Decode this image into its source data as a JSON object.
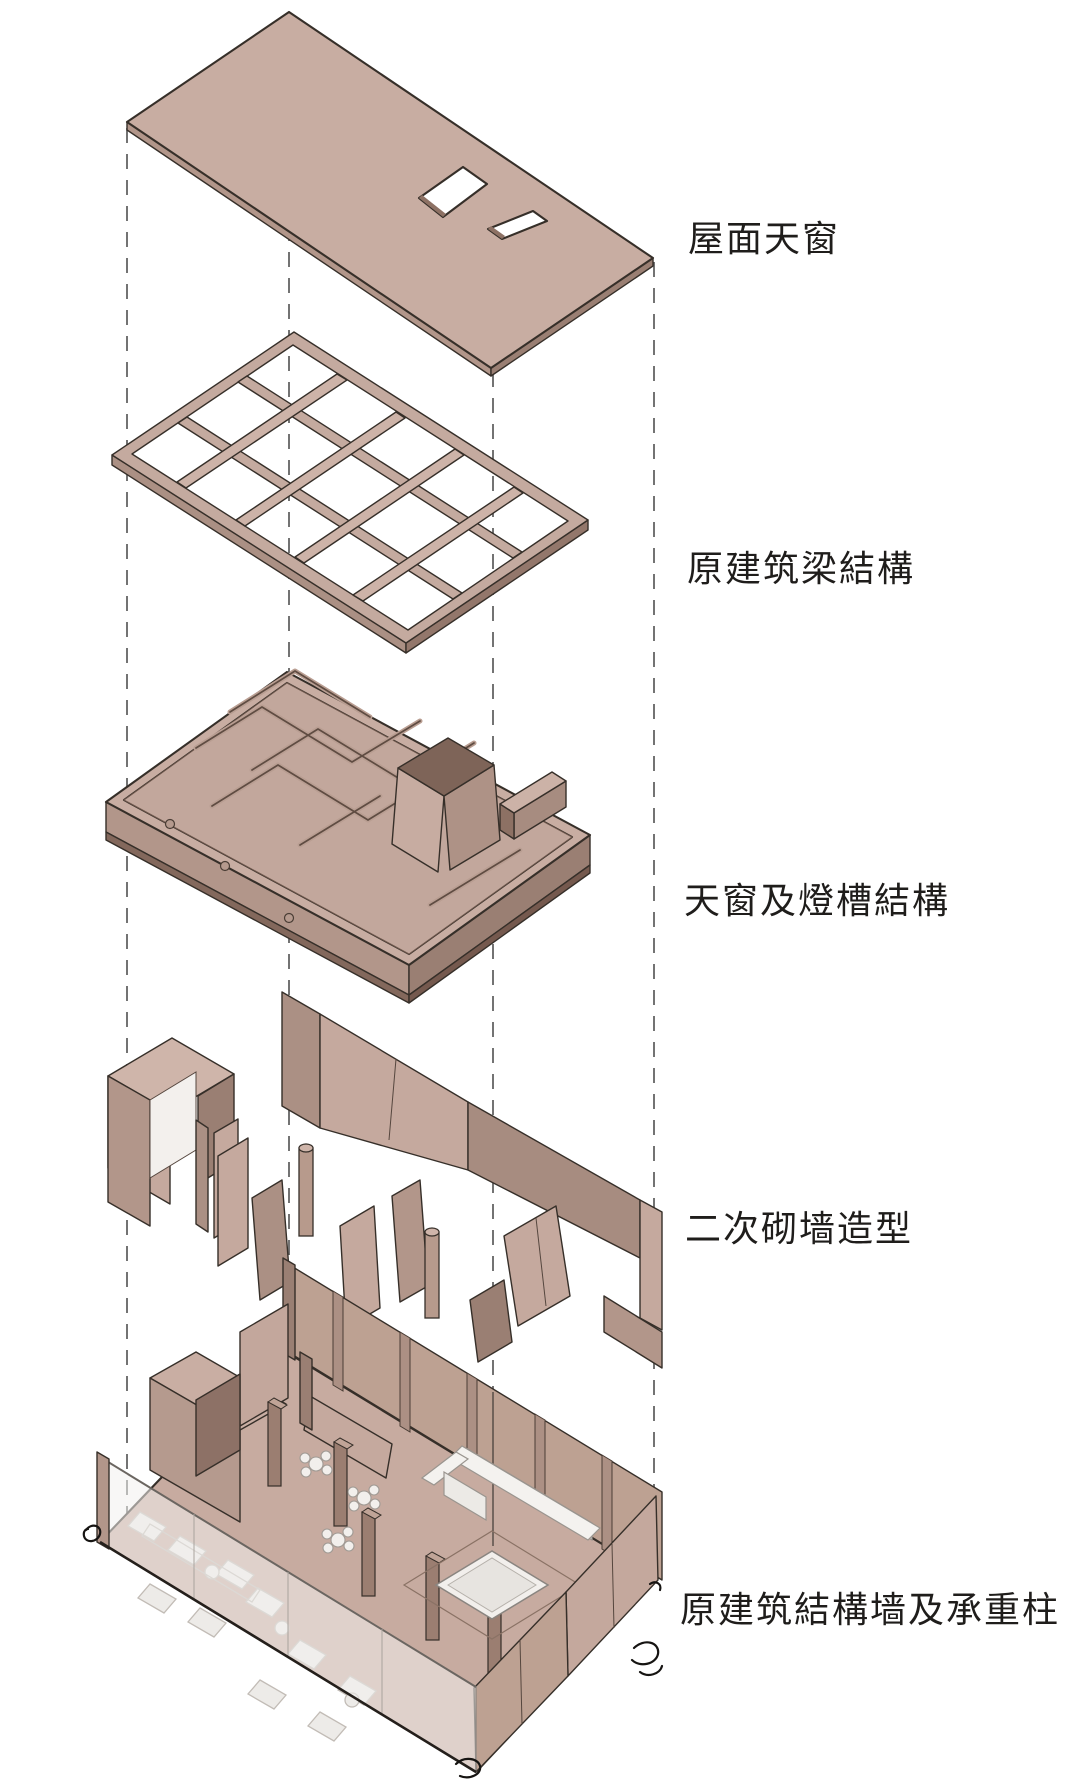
{
  "diagram": {
    "type": "exploded-axonometric-architecture-diagram",
    "labels": [
      {
        "id": "roof-skylight",
        "text": "屋面天窗"
      },
      {
        "id": "original-beam-structure",
        "text": "原建筑梁結構"
      },
      {
        "id": "skylight-lightcove-structure",
        "text": "天窗及燈槽結構"
      },
      {
        "id": "secondary-masonry-walls",
        "text": "二次砌墙造型"
      },
      {
        "id": "original-structural-walls-columns",
        "text": "原建筑結構墙及承重柱"
      }
    ],
    "layers": [
      {
        "name": "roof-skylight-layer"
      },
      {
        "name": "beam-grid-layer"
      },
      {
        "name": "skylight-lightcove-layer"
      },
      {
        "name": "masonry-wall-layer"
      },
      {
        "name": "base-structure-layer"
      }
    ],
    "palette": {
      "face": "#c8ada2",
      "face_light": "#cfb5aa",
      "side": "#b2968a",
      "side_dark": "#9a7f73",
      "deep": "#7e6458",
      "floor": "#c2a79c",
      "outline": "#362f29",
      "white_furniture": "#f2efec",
      "glass": "rgba(242,240,238,0.55)",
      "dash": "#5b5b5b",
      "label_text": "#1f1d1b"
    }
  }
}
